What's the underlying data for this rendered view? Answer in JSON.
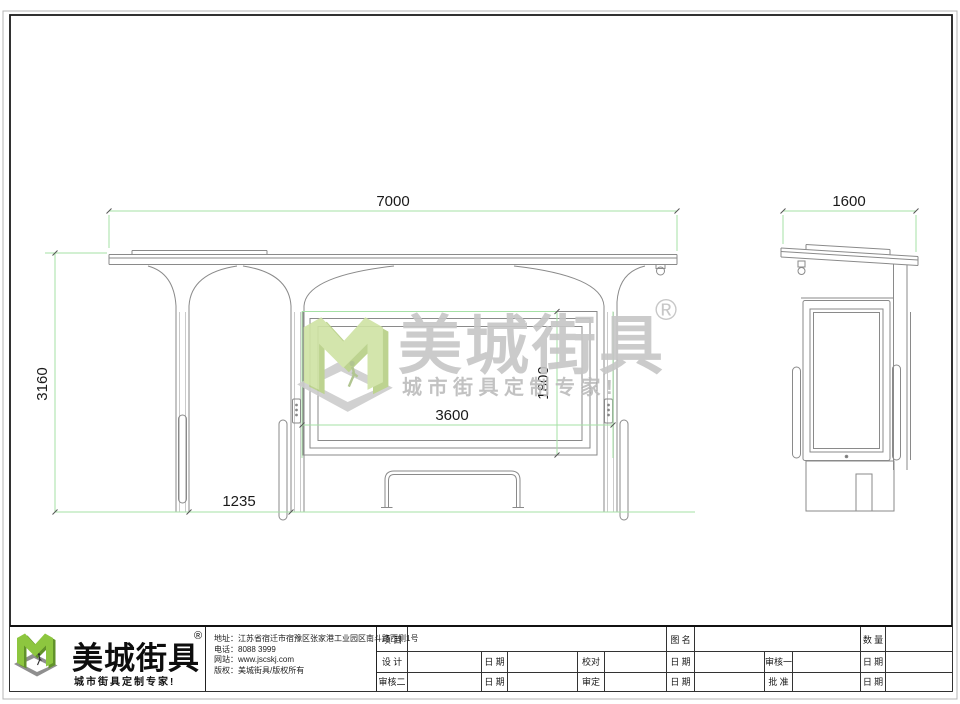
{
  "front_view": {
    "overall_width": "7000",
    "overall_height": "3160",
    "panel_width": "3600",
    "panel_height": "1800",
    "column_spacing": "1235"
  },
  "side_view": {
    "overall_depth": "1600"
  },
  "watermark": {
    "brand": "美城街具",
    "registered": "®",
    "tagline": "城市街具定制专家!"
  },
  "title_block": {
    "logo": {
      "brand": "美城街具",
      "registered": "®",
      "tagline": "城市街具定制专家!"
    },
    "company": {
      "address": "地址：江苏省宿迁市宿豫区张家港工业园区南斗路西侧1号",
      "phone": "电话：8088 3999",
      "website": "网站：www.jscskj.com",
      "copyright": "版权：美城街具/版权所有"
    },
    "table": {
      "project": "项 目",
      "drawing_name": "图 名",
      "quantity": "数 量",
      "design": "设 计",
      "date_a": "日 期",
      "proofread": "校对",
      "date_b": "日 期",
      "reviewer1": "审核一",
      "date_c": "日 期",
      "reviewer2": "审核二",
      "date_d": "日 期",
      "verify": "审定",
      "date_e": "日 期",
      "approve": "批 准",
      "date_f": "日 期"
    }
  },
  "colors": {
    "dimension_line": "#a5e0a5",
    "drawing_line": "#8a8a8a",
    "logo_green": "#8dc63f",
    "frame": "#1c1c1c"
  }
}
